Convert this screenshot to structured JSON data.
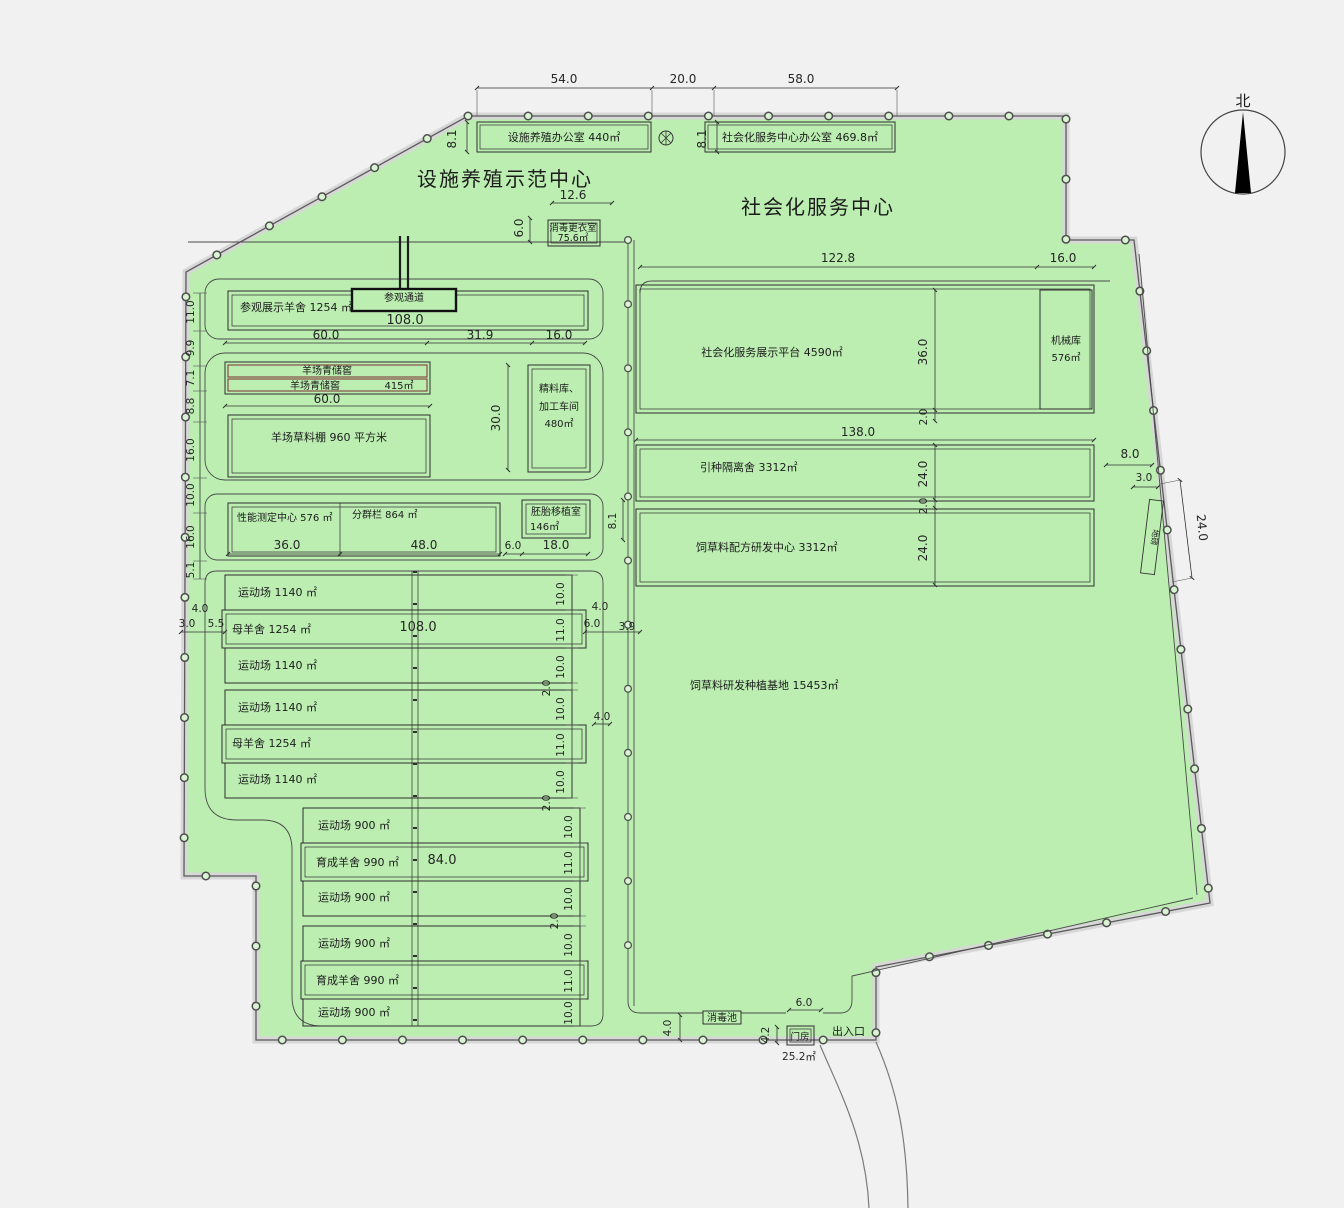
{
  "titles": {
    "facility": "设施养殖示范中心",
    "service": "社会化服务中心",
    "north": "北"
  },
  "buildings": {
    "facility_office": "设施养殖办公室 440㎡",
    "service_office": "社会化服务中心办公室 469.8㎡",
    "disinfect_change_1": "消毒更衣室",
    "disinfect_change_2": "75.6㎡",
    "display_barn": "参观展示羊舍 1254 ㎡",
    "visit_corridor": "参观通道",
    "silo_1": "羊场青储窖",
    "silo_2": "羊场青储窖",
    "silo_area": "415㎡",
    "forage_shed": "羊场草料棚 960 平方米",
    "feed_1": "精料库、",
    "feed_2": "加工车间",
    "feed_3": "480㎡",
    "perf_center": "性能测定中心 576 ㎡",
    "group_pen": "分群栏 864 ㎡",
    "embryo_1": "胚胎移植室",
    "embryo_2": "146㎡",
    "platform": "社会化服务展示平台 4590㎡",
    "machinery_1": "机械库",
    "machinery_2": "576㎡",
    "quarantine": "引种隔离舍 3312㎡",
    "formula": "饲草料配方研发中心 3312㎡",
    "base": "饲草料研发种植基地 15453㎡",
    "pool": "消毒池",
    "gatehouse": "门房",
    "gatehouse_area": "25.2㎡",
    "entrance": "出入口",
    "scale": "地磅"
  },
  "rows": [
    "运动场 1140 ㎡",
    "母羊舍 1254 ㎡",
    "运动场 1140 ㎡",
    "运动场 1140 ㎡",
    "母羊舍 1254 ㎡",
    "运动场 1140 ㎡",
    "运动场 900 ㎡",
    "育成羊舍 990 ㎡",
    "运动场 900 ㎡",
    "运动场 900 ㎡",
    "育成羊舍 990 ㎡",
    "运动场 900 ㎡"
  ],
  "dims": {
    "top": [
      "54.0",
      "20.0",
      "58.0"
    ],
    "office_h": "8.1",
    "dc_w": "12.6",
    "dc_h": "6.0",
    "left": [
      "11.0",
      "9.9",
      "7.1",
      "8.8",
      "16.0",
      "10.0",
      "16.0",
      "5.1"
    ],
    "barn_w": "108.0",
    "chain": [
      "60.0",
      "31.9",
      "16.0"
    ],
    "silo_w": "60.0",
    "feed_h": "30.0",
    "perf": [
      "36.0",
      "48.0",
      "6.0",
      "18.0"
    ],
    "embryo_h": "8.1",
    "lb": [
      "4.0",
      "3.0",
      "5.5"
    ],
    "rb": [
      "4.0",
      "6.0",
      "3.9"
    ],
    "r4": "4.0",
    "h10": "10.0",
    "h11": "11.0",
    "g2": "2.0",
    "ewe_w": "108.0",
    "young_w": "84.0",
    "rt": [
      "122.8",
      "16.0"
    ],
    "plat_h": "36.0",
    "w138": "138.0",
    "h24": "24.0",
    "or": [
      "8.0",
      "3.0",
      "24.0"
    ],
    "pool_h": "4.0",
    "gate_w": "6.0",
    "gate_h": "4.2"
  }
}
